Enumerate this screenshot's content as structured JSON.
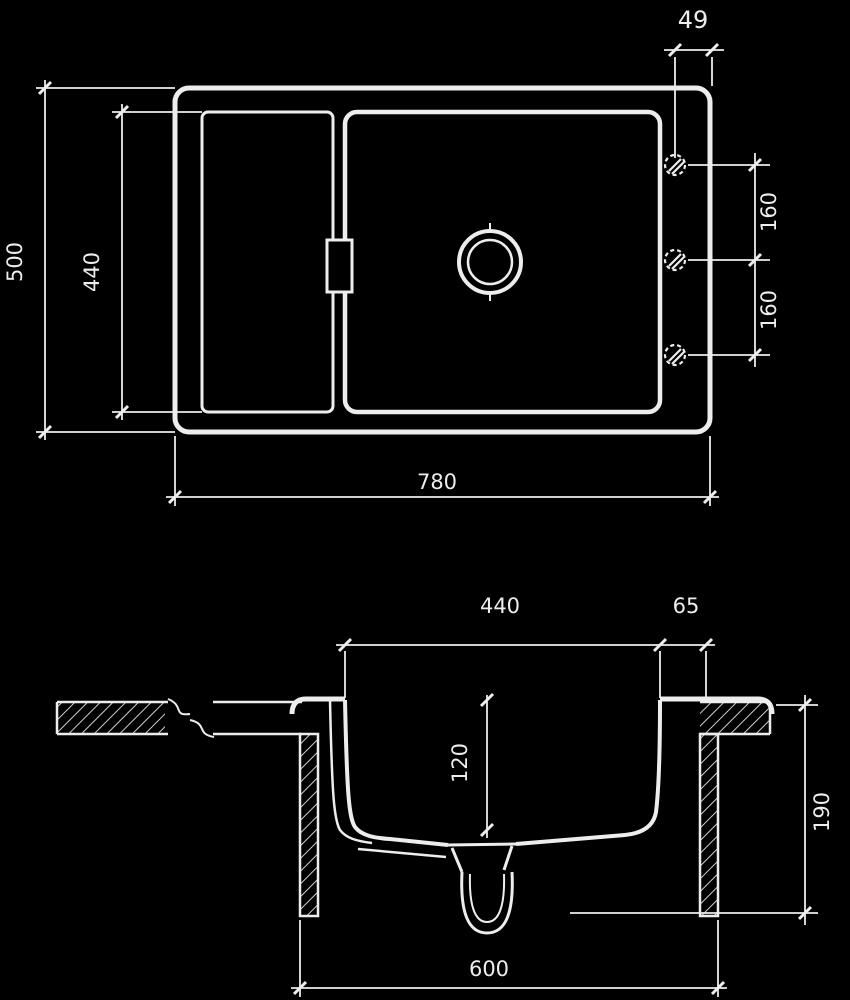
{
  "drawing": {
    "type": "sink installation technical drawing",
    "background_color": "#000000",
    "line_color": "#ededed",
    "top_view": {
      "dim_hole_offset": "49",
      "dim_overall_depth": "500",
      "dim_bowl_depth": "440",
      "dim_hole_spacing_upper": "160",
      "dim_hole_spacing_lower": "160",
      "dim_overall_width": "780"
    },
    "section_view": {
      "dim_bowl_width": "440",
      "dim_right_ledge": "65",
      "dim_front_depth": "120",
      "dim_bowl_height": "190",
      "dim_cabinet_width": "600"
    }
  }
}
